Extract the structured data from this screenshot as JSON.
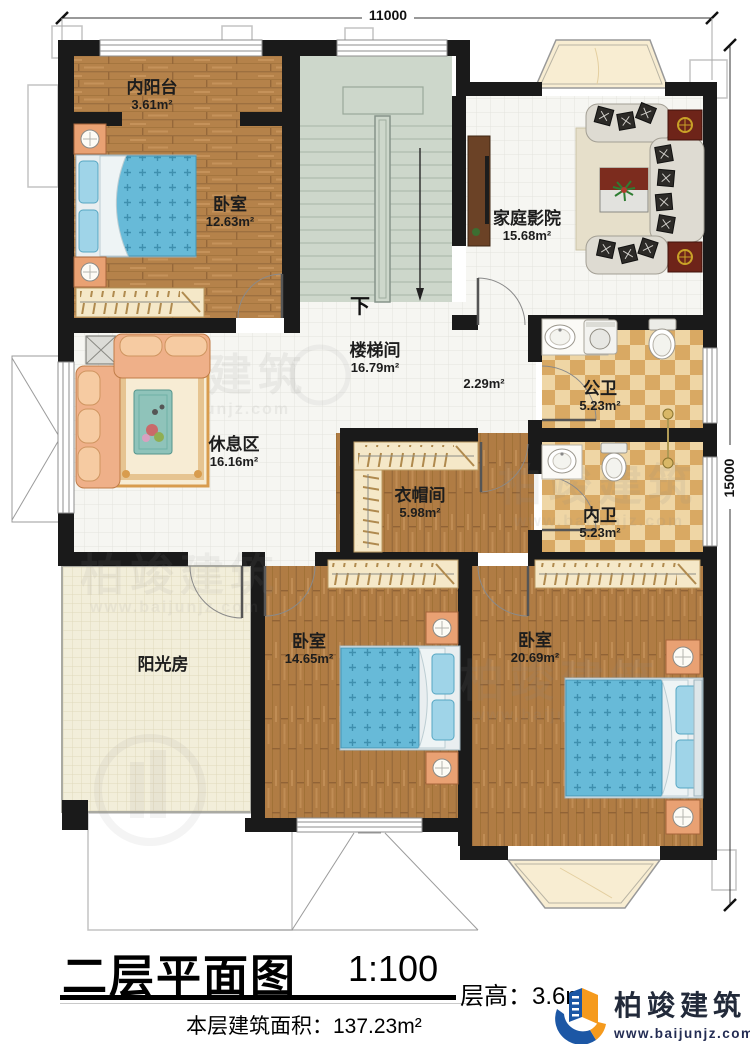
{
  "dims": {
    "top": "11000",
    "right": "15000"
  },
  "rooms": {
    "balcony": {
      "name": "内阳台",
      "area": "3.61m²"
    },
    "bedroom1": {
      "name": "卧室",
      "area": "12.63m²"
    },
    "stairwell": {
      "name": "楼梯间",
      "area": "16.79m²",
      "down": "下"
    },
    "hall": {
      "area": "2.29m²"
    },
    "theater": {
      "name": "家庭影院",
      "area": "15.68m²"
    },
    "publicBath": {
      "name": "公卫",
      "area": "5.23m²"
    },
    "privateBath": {
      "name": "内卫",
      "area": "5.23m²"
    },
    "lounge": {
      "name": "休息区",
      "area": "16.16m²"
    },
    "cloakroom": {
      "name": "衣帽间",
      "area": "5.98m²"
    },
    "sunroom": {
      "name": "阳光房"
    },
    "bedroom2": {
      "name": "卧室",
      "area": "14.65m²"
    },
    "bedroom3": {
      "name": "卧室",
      "area": "20.69m²"
    }
  },
  "titleBlock": {
    "title": "二层平面图",
    "scale": "1:100",
    "floorHeight": "层高：3.6m",
    "floorAreaLabel": "本层建筑面积：",
    "floorAreaValue": "137.23m²"
  },
  "brand": {
    "name": "柏竣建筑",
    "website": "www.baijunjz.com"
  },
  "watermark": {
    "text": "柏竣建筑",
    "website": "www.baijunjz.com"
  },
  "colors": {
    "wall": "#1a1a1a",
    "wood": "#b5824a",
    "stair": "#cdd7cb",
    "bathTile": "#d9a963",
    "brandBlue": "#1c57a5",
    "brandOrange": "#f59a1d"
  }
}
